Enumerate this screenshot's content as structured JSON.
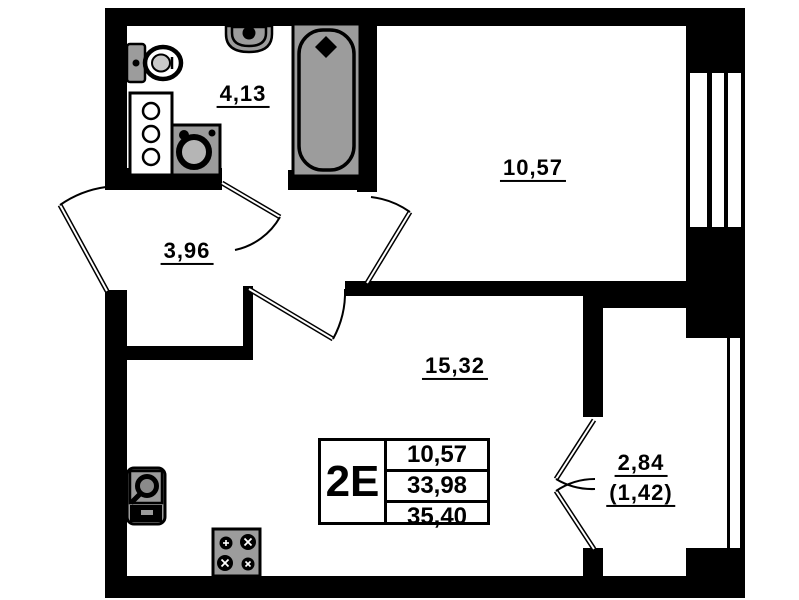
{
  "plan": {
    "areas": {
      "bathroom": "4,13",
      "hallway": "3,96",
      "bedroom": "10,57",
      "living_room": "15,32",
      "balcony_total": "2,84",
      "balcony_counted": "(1,42)"
    },
    "summary_table": {
      "unit_label": "2Е",
      "living_area": "10,57",
      "area_without_balcony": "33,98",
      "total_area": "35,40"
    },
    "colors": {
      "walls": "#000000",
      "fixtures": "#9c9c9c",
      "paper": "#ffffff"
    }
  }
}
